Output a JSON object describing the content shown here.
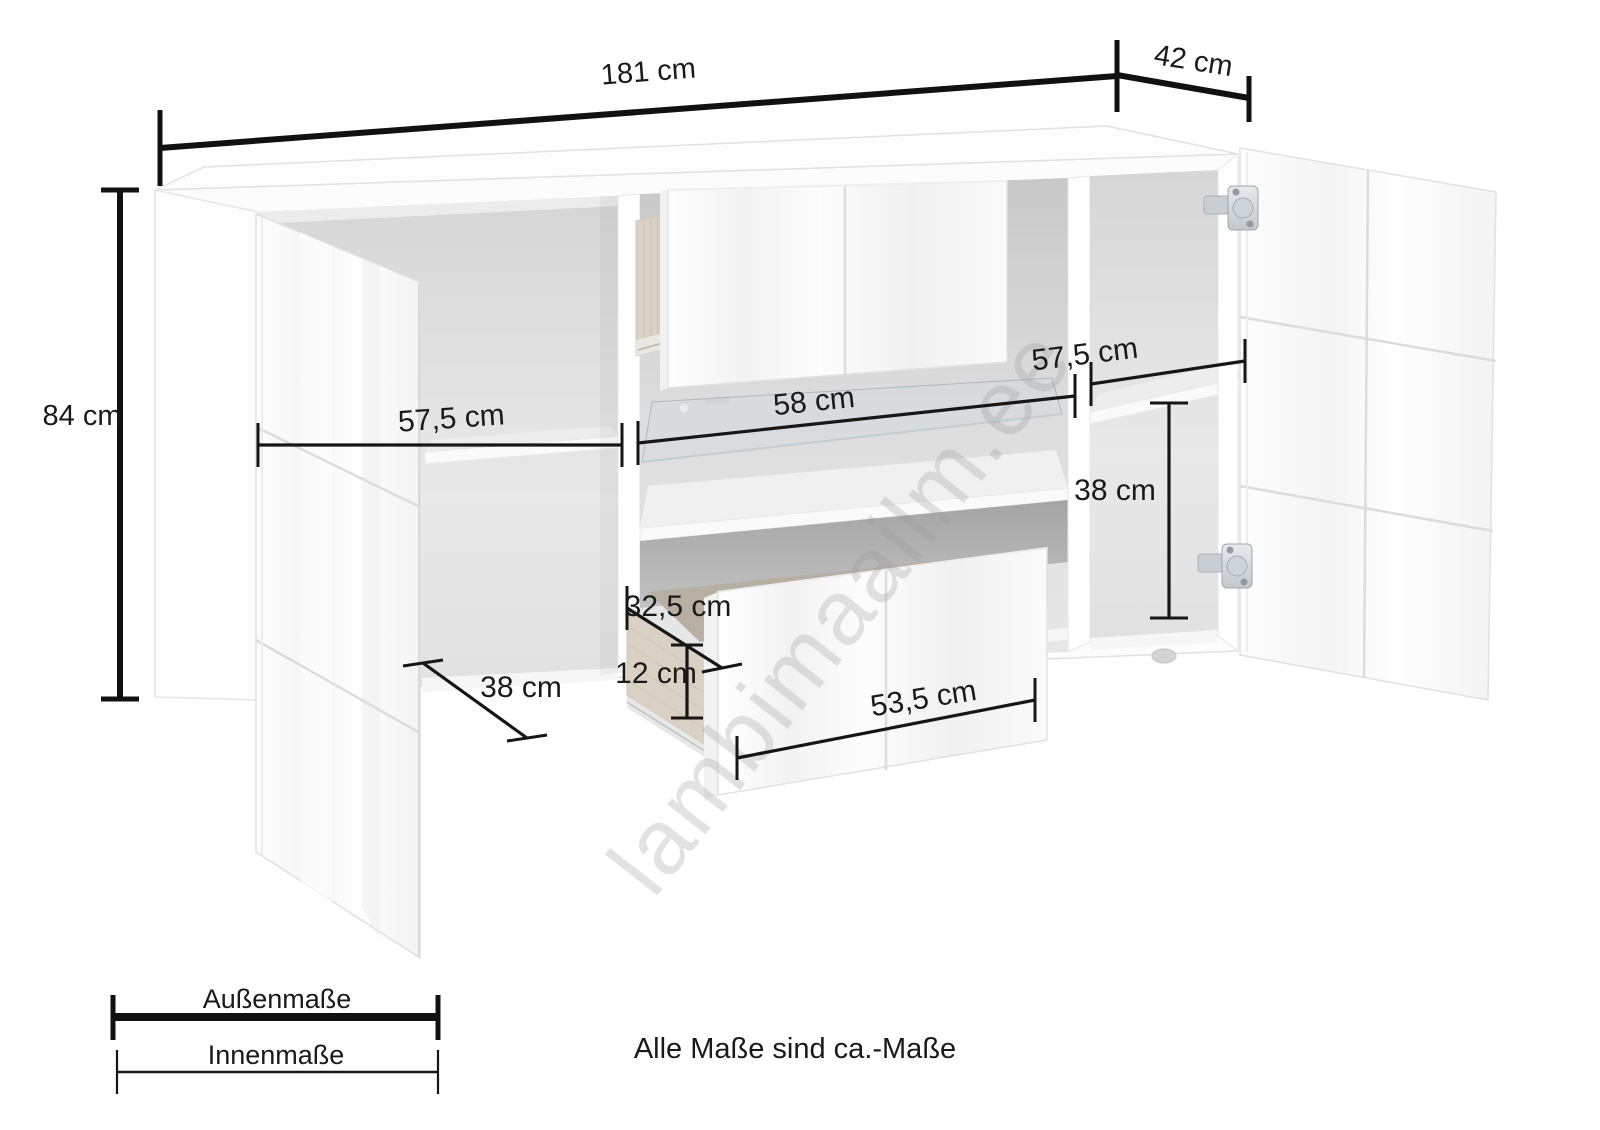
{
  "diagram": {
    "watermark": "lambimaailm.ee",
    "note": "Alle Maße sind ca.-Maße",
    "legend": {
      "outer_label": "Außenmaße",
      "inner_label": "Innenmaße"
    },
    "dimensions": {
      "outer": {
        "width": {
          "label": "181 cm",
          "cm": 181
        },
        "depth": {
          "label": "42 cm",
          "cm": 42
        },
        "height": {
          "label": "84 cm",
          "cm": 84
        }
      },
      "inner": {
        "left_compartment_width": {
          "label": "57,5 cm",
          "cm": 57.5
        },
        "middle_compartment_width": {
          "label": "58 cm",
          "cm": 58
        },
        "right_compartment_width": {
          "label": "57,5 cm",
          "cm": 57.5
        },
        "right_compartment_height": {
          "label": "38 cm",
          "cm": 38
        },
        "left_compartment_depth": {
          "label": "38 cm",
          "cm": 38
        },
        "drawer_inner_depth": {
          "label": "32,5 cm",
          "cm": 32.5
        },
        "drawer_inner_height": {
          "label": "12 cm",
          "cm": 12
        },
        "drawer_front_width": {
          "label": "53,5 cm",
          "cm": 53.5
        }
      }
    },
    "colors": {
      "background": "#ffffff",
      "dimension_line": "#161616",
      "interior_gray": "#dddddd",
      "wood": "#d9d1c3",
      "watermark_gray": "#9a9a9a"
    }
  }
}
